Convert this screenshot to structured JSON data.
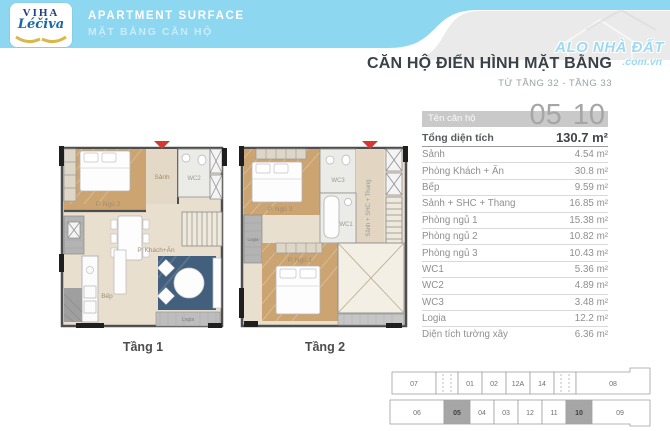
{
  "header": {
    "logo": {
      "brand_top": "VIHA",
      "brand_script": "Léčiva"
    },
    "title_en": "APARTMENT SURFACE",
    "title_vi": "MẶT BẰNG CĂN HỘ",
    "watermark": {
      "line1": "ALO NHÀ ĐẤT",
      "line2": ".com.vn"
    }
  },
  "info": {
    "title": "CĂN HỘ ĐIỂN HÌNH MẶT BẰNG",
    "subtitle": "TỪ TẦNG 32 - TẦNG 33",
    "unit_label": "Tên căn hộ",
    "unit_numbers": [
      "05",
      "10"
    ],
    "total_label": "Tổng diện tích",
    "total_value": "130.7 m²",
    "rows": [
      {
        "label": "Sảnh",
        "value": "4.54 m²"
      },
      {
        "label": "Phòng Khách + Ăn",
        "value": "30.8 m²"
      },
      {
        "label": "Bếp",
        "value": "9.59 m²"
      },
      {
        "label": "Sảnh + SHC + Thang",
        "value": "16.85 m²"
      },
      {
        "label": "Phòng ngủ 1",
        "value": "15.38 m²"
      },
      {
        "label": "Phòng ngủ 2",
        "value": "10.82 m²"
      },
      {
        "label": "Phòng ngủ 3",
        "value": "10.43 m²"
      },
      {
        "label": "WC1",
        "value": "5.36 m²"
      },
      {
        "label": "WC2",
        "value": "4.89 m²"
      },
      {
        "label": "WC3",
        "value": "3.48 m²"
      },
      {
        "label": "Logia",
        "value": "12.2 m²"
      },
      {
        "label": "Diện tích tường xây",
        "value": "6.36 m²"
      }
    ]
  },
  "plans": [
    {
      "caption": "Tầng 1",
      "labels": {
        "bedroom2": "P. Ngủ 2",
        "hall": "Sảnh",
        "wc2": "WC2",
        "living": "P. Khách+Ăn",
        "kitchen": "Bếp",
        "logia": "Logia"
      }
    },
    {
      "caption": "Tầng 2",
      "labels": {
        "bedroom3": "P. Ngủ 3",
        "wc3": "WC3",
        "hall": "Sảnh + SHC + Thang",
        "wc1": "WC1",
        "bedroom1": "P. Ngủ 1",
        "logia": "Logia"
      }
    }
  ],
  "keyplan": {
    "top_row": [
      "07",
      "01",
      "02",
      "12A",
      "14",
      "08"
    ],
    "bottom_row": [
      "06",
      "05",
      "04",
      "03",
      "12",
      "11",
      "10",
      "09"
    ],
    "highlighted": [
      "05",
      "10"
    ]
  },
  "colors": {
    "header_blue": "#8ed7f1",
    "header_gray": "#eaeaea",
    "unit_bar_gray": "#c9c9c9",
    "keyplan_highlight": "#a6a6a6",
    "entrance_arrow_red": "#d23b2f",
    "rug_blue": "#42607e",
    "wood_floor": "#cba471",
    "plan_floor": "#e9dfcf"
  }
}
